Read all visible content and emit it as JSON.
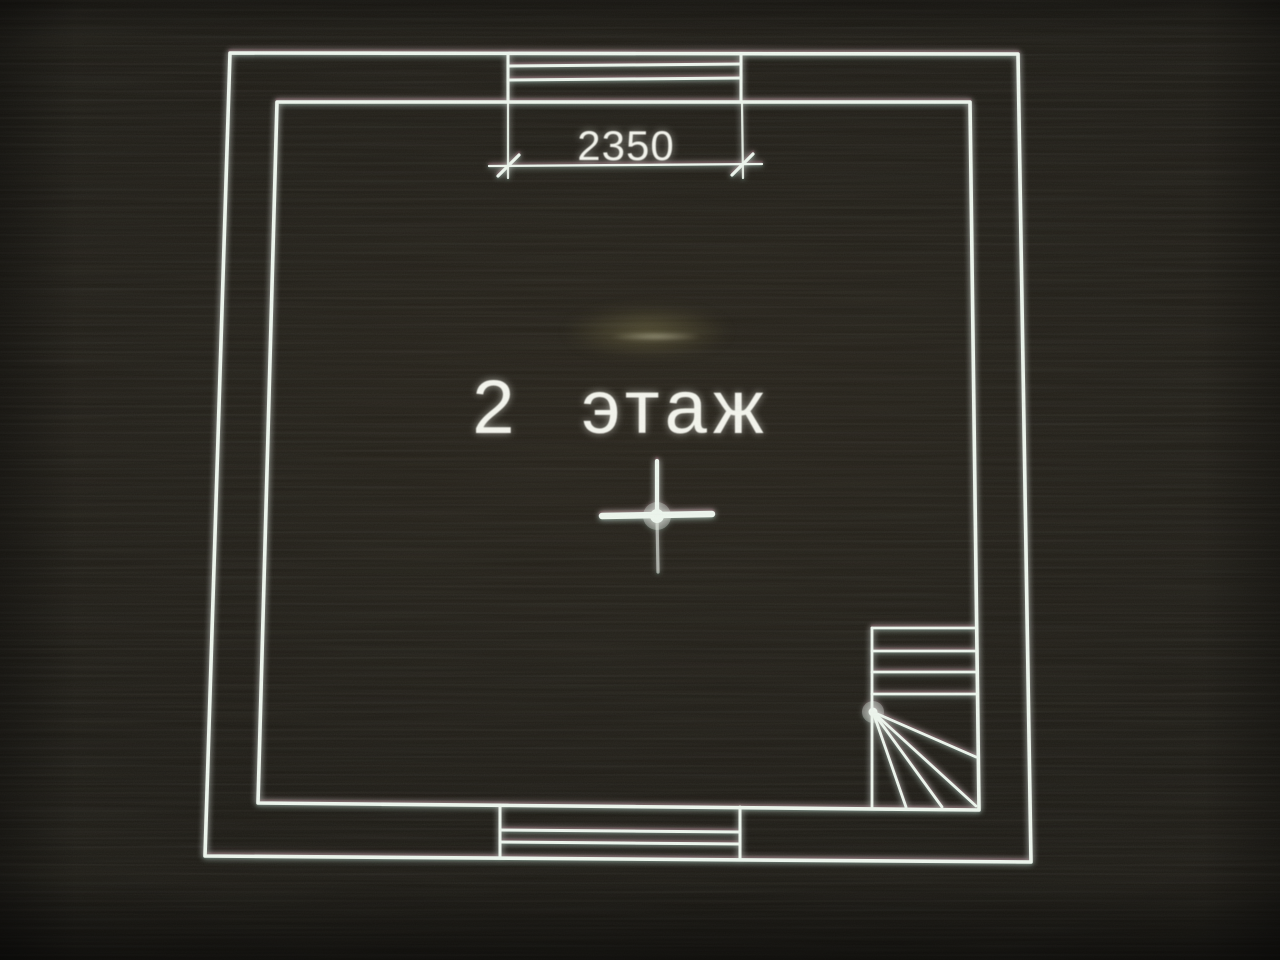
{
  "plan": {
    "floor_label": "2 этаж",
    "dimension_label": "2350",
    "colors": {
      "background": "#211e17",
      "line": "#eef7ee",
      "text": "#f5f6ee"
    }
  }
}
